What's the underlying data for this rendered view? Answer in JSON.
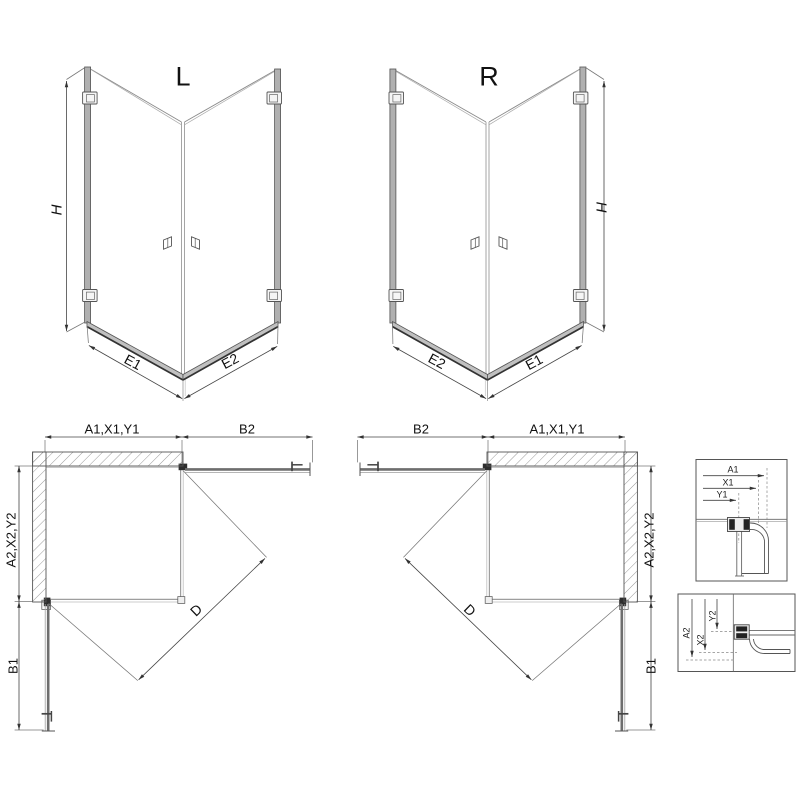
{
  "page": {
    "background": "#ffffff",
    "line_color": "#555555",
    "glass_color": "#a0a0a0",
    "rail_color": "#c0c0c0",
    "hinge_dark": "#2e2e2e"
  },
  "views": {
    "front_left": {
      "title": "L",
      "height_dim": "H",
      "bottom_left_dim": "E1",
      "bottom_right_dim": "E2"
    },
    "front_right": {
      "title": "R",
      "height_dim": "H",
      "bottom_left_dim": "E2",
      "bottom_right_dim": "E1"
    },
    "plan_left": {
      "top_span_dim": "A1,X1,Y1",
      "door_span_dim": "B2",
      "side_span_dim": "A2,X2,Y2",
      "side_door_dim": "B1",
      "diagonal_dim": "D"
    },
    "plan_right": {
      "top_span_dim": "A1,X1,Y1",
      "door_span_dim": "B2",
      "side_span_dim": "A2,X2,Y2",
      "side_door_dim": "B1",
      "diagonal_dim": "D"
    },
    "detail_horizontal": {
      "dims": [
        "A1",
        "X1",
        "Y1"
      ]
    },
    "detail_vertical": {
      "dims": [
        "A2",
        "X2",
        "Y2"
      ]
    }
  }
}
